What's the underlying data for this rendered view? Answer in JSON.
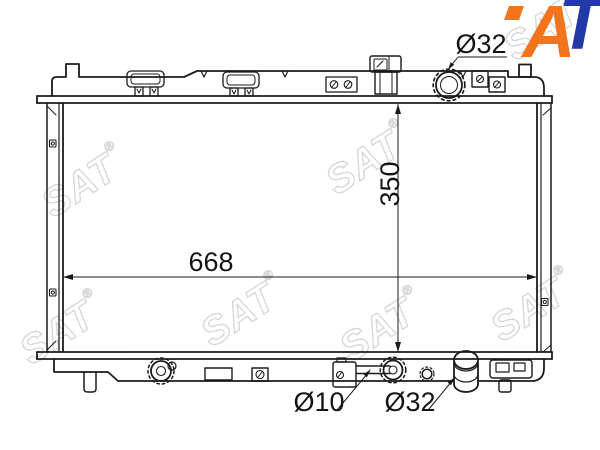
{
  "page": {
    "background": "#ffffff"
  },
  "logo": {
    "letter_a": "A",
    "letter_t": "T",
    "orange": "#f4731d",
    "blue": "#2239a8"
  },
  "watermark": {
    "text": "SAT",
    "registered": "®",
    "color": "#d6d6d6"
  },
  "dimensions": {
    "filler_neck_diameter": "Ø32",
    "core_height": "350",
    "core_width": "668",
    "drain_pipe_diameter": "Ø10",
    "outlet_pipe_diameter": "Ø32"
  }
}
